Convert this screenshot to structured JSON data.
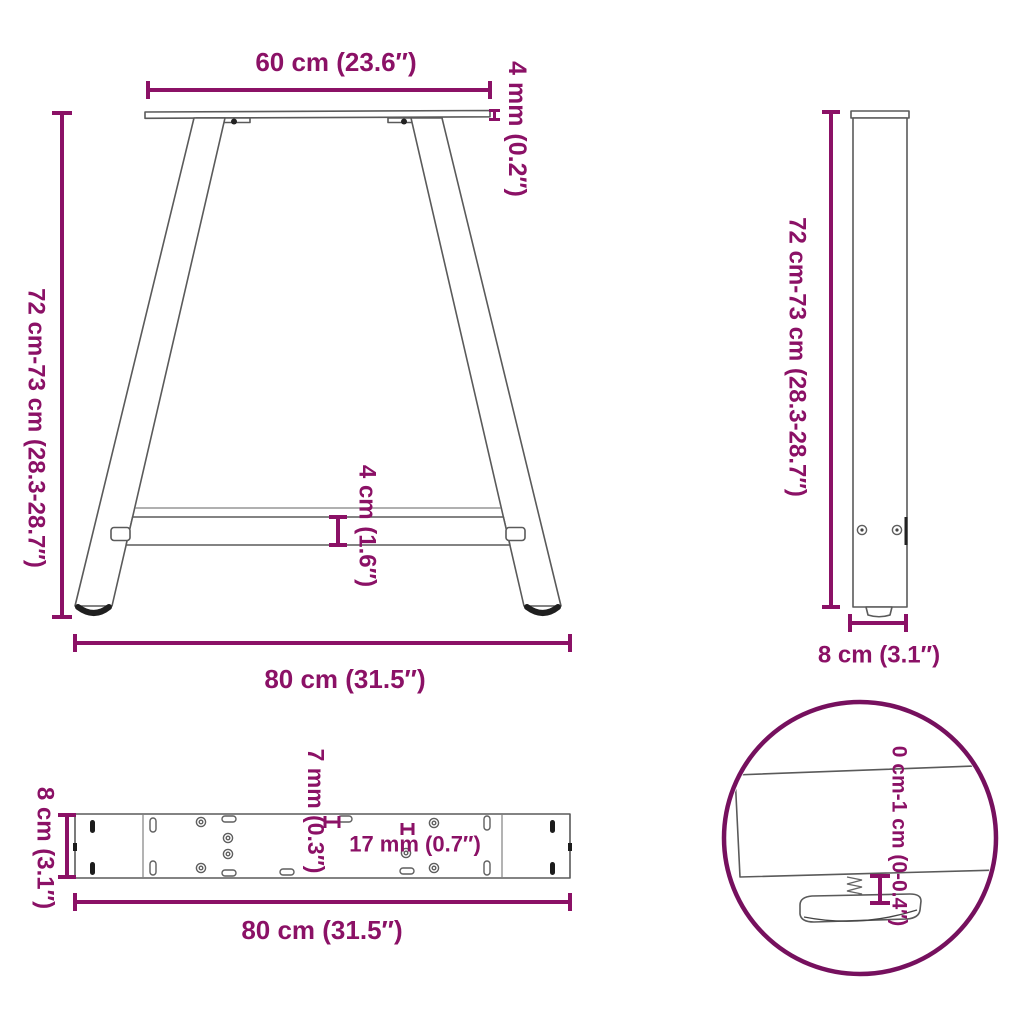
{
  "diagram": {
    "accent_color": "#8B1166",
    "detail_circle_color": "#76105E",
    "line_color": "#5a5a5a",
    "front_view": {
      "top_width_label": "60 cm (23.6″)",
      "plate_thickness_label": "4 mm (0.2″)",
      "height_label": "72 cm-73 cm (28.3-28.7″)",
      "crossbar_height_label": "4 cm (1.6″)",
      "base_width_label": "80 cm (31.5″)"
    },
    "side_view": {
      "height_label": "72 cm-73 cm (28.3-28.7″)",
      "depth_label": "8 cm (3.1″)"
    },
    "top_view": {
      "width_label": "8 cm (3.1″)",
      "length_label": "80 cm (31.5″)",
      "hole_diameter_label": "7 mm (0.3″)",
      "slot_length_label": "17 mm (0.7″)"
    },
    "detail_view": {
      "adjustment_range_label": "0 cm-1 cm (0-0.4″)"
    }
  }
}
